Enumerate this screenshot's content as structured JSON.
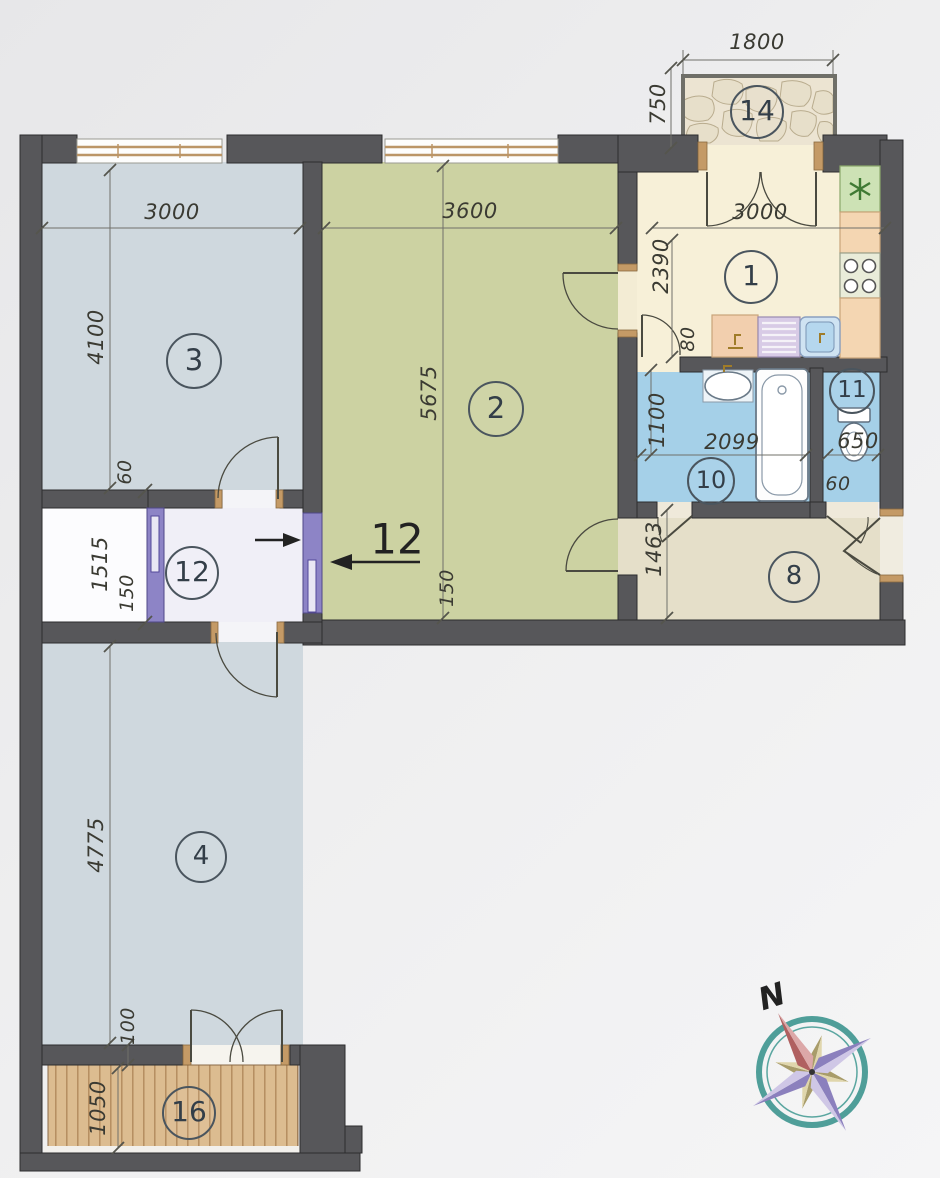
{
  "plan": {
    "type": "apartment-floor-plan",
    "rooms": [
      {
        "number": "1",
        "dimensions": [
          "3000",
          "2390",
          "80"
        ]
      },
      {
        "number": "2",
        "dimensions": [
          "3600",
          "5675",
          "150"
        ]
      },
      {
        "number": "3",
        "dimensions": [
          "3000",
          "4100",
          "60"
        ]
      },
      {
        "number": "4",
        "dimensions": [
          "4775",
          "100"
        ]
      },
      {
        "number": "8",
        "dimensions": [
          "1463"
        ]
      },
      {
        "number": "10",
        "dimensions": [
          "1100",
          "2099"
        ]
      },
      {
        "number": "11",
        "dimensions": [
          "650",
          "60"
        ]
      },
      {
        "number": "12",
        "dimensions": [
          "1515",
          "150"
        ]
      },
      {
        "number": "14",
        "dimensions": [
          "1800",
          "750"
        ]
      },
      {
        "number": "16",
        "dimensions": [
          "1050"
        ]
      }
    ],
    "renovation_annotation": "12",
    "compass_label": "N"
  },
  "colors": {
    "wall": "#57575a",
    "room_bluegray": "#cfd8de",
    "room_olive": "#ccd2a2",
    "kitchen_cream": "#f7f0d8",
    "bath_blue": "#a5d0e8",
    "hall_beige": "#e5dfc9",
    "corridor_white": "#f0eff7",
    "accent_purple": "#8d84c6",
    "wood": "#dcbc90",
    "stone": "#ece4d2",
    "compass_teal": "#4f9e99"
  },
  "dimension_labels": [
    {
      "text": "1800",
      "x": 757,
      "y": 42,
      "rot": 0
    },
    {
      "text": "750",
      "x": 658,
      "y": 104,
      "rot": -90
    },
    {
      "text": "3000",
      "x": 760,
      "y": 212,
      "rot": 0
    },
    {
      "text": "2390",
      "x": 661,
      "y": 266,
      "rot": -90
    },
    {
      "text": "80",
      "x": 688,
      "y": 339,
      "rot": -90,
      "size": 19
    },
    {
      "text": "1100",
      "x": 657,
      "y": 420,
      "rot": -90
    },
    {
      "text": "2099",
      "x": 732,
      "y": 442,
      "rot": 0
    },
    {
      "text": "650",
      "x": 858,
      "y": 441,
      "rot": 0
    },
    {
      "text": "60",
      "x": 838,
      "y": 484,
      "rot": 0,
      "size": 19
    },
    {
      "text": "1463",
      "x": 654,
      "y": 549,
      "rot": -90
    },
    {
      "text": "3000",
      "x": 172,
      "y": 212,
      "rot": 0
    },
    {
      "text": "4100",
      "x": 96,
      "y": 337,
      "rot": -90
    },
    {
      "text": "3600",
      "x": 470,
      "y": 211,
      "rot": 0
    },
    {
      "text": "5675",
      "x": 429,
      "y": 393,
      "rot": -90
    },
    {
      "text": "60",
      "x": 125,
      "y": 472,
      "rot": -90,
      "size": 19
    },
    {
      "text": "1515",
      "x": 100,
      "y": 564,
      "rot": -90
    },
    {
      "text": "150",
      "x": 127,
      "y": 593,
      "rot": -90,
      "size": 19
    },
    {
      "text": "150",
      "x": 447,
      "y": 588,
      "rot": -90,
      "size": 19
    },
    {
      "text": "4775",
      "x": 96,
      "y": 845,
      "rot": -90
    },
    {
      "text": "100",
      "x": 128,
      "y": 1026,
      "rot": -90,
      "size": 19
    },
    {
      "text": "1050",
      "x": 98,
      "y": 1108,
      "rot": -90
    }
  ],
  "room_markers": [
    {
      "text": "14",
      "x": 757,
      "y": 112,
      "r": 25
    },
    {
      "text": "1",
      "x": 751,
      "y": 277,
      "r": 25
    },
    {
      "text": "3",
      "x": 194,
      "y": 361,
      "r": 26
    },
    {
      "text": "2",
      "x": 496,
      "y": 409,
      "r": 26
    },
    {
      "text": "10",
      "x": 711,
      "y": 481,
      "r": 22
    },
    {
      "text": "11",
      "x": 852,
      "y": 391,
      "r": 21
    },
    {
      "text": "8",
      "x": 794,
      "y": 577,
      "r": 24
    },
    {
      "text": "12",
      "x": 192,
      "y": 573,
      "r": 25
    },
    {
      "text": "4",
      "x": 201,
      "y": 857,
      "r": 24
    },
    {
      "text": "16",
      "x": 189,
      "y": 1113,
      "r": 25
    }
  ],
  "annotations": [
    {
      "text": "12",
      "x": 397,
      "y": 539,
      "size": 42,
      "rot": 0,
      "name": "renovation-number",
      "bold": false
    },
    {
      "text": "N",
      "x": 772,
      "y": 997,
      "size": 31,
      "rot": -18,
      "name": "compass-north-label",
      "bold": true
    }
  ]
}
